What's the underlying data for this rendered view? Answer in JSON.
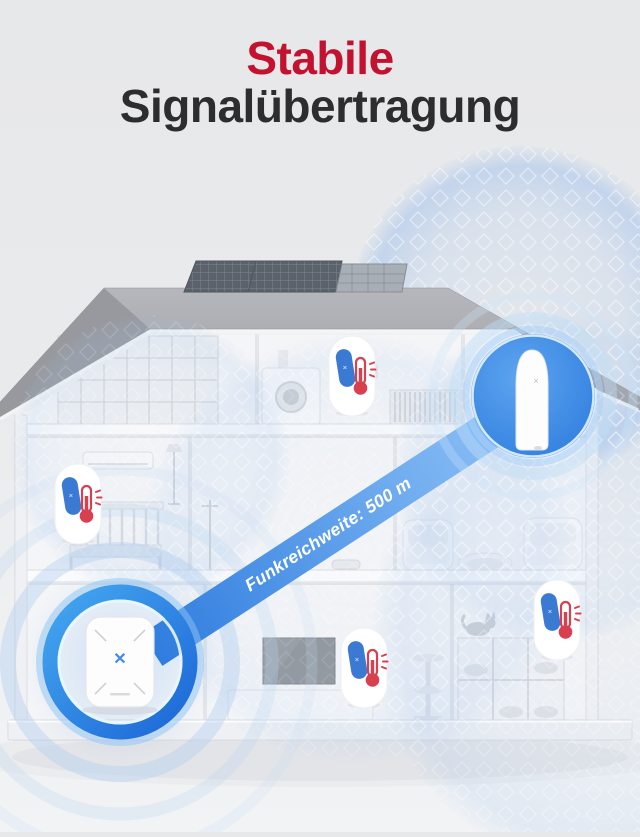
{
  "title": {
    "line1": "Stabile",
    "line2": "Signalübertragung"
  },
  "beam": {
    "label": "Funkreichweite: 500 m"
  },
  "devices": {
    "hub_logo_glyph": "✕",
    "entry_sensor_logo_glyph": "×",
    "badge_sensor_logo_glyph": "×"
  },
  "icons": {
    "thermometer": "thermometer-icon",
    "signal_mesh": "signal-range-mesh-icon",
    "solar_panel": "solar-panel-icon",
    "hub": "base-station-icon",
    "entry_sensor": "capsule-sensor-icon"
  },
  "colors": {
    "title_accent": "#c31230",
    "title_main": "#2d2d2f",
    "beam_start": "#2f7ddf",
    "beam_end": "#8cc0f6",
    "signal_blue": "#a4c3ec",
    "device_circle_blue": "#2f7ad9",
    "thermometer_red": "#d9404f",
    "sensor_capsule_blue": "#3b7ad2",
    "roof_gray": "#a5a7ac",
    "background": "#e8e9eb"
  }
}
